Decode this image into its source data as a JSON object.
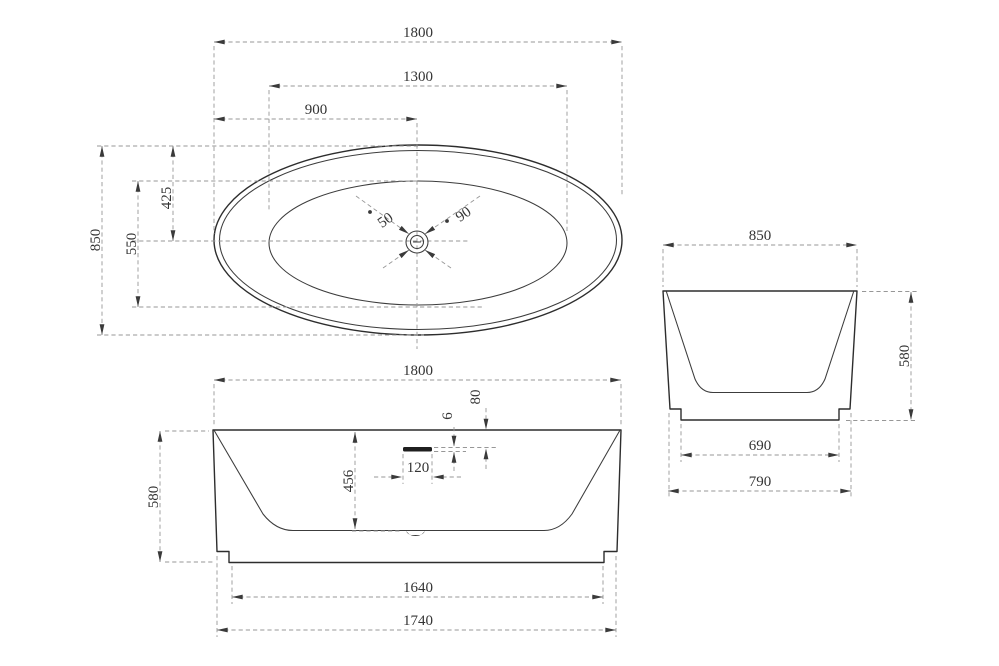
{
  "views": {
    "top": {
      "dims": {
        "overall_length": "1800",
        "basin_length": "1300",
        "drain_offset": "900",
        "overall_width": "850",
        "basin_width": "550",
        "half_width": "425",
        "drain_diameter": "50",
        "overflow_diameter": "90"
      }
    },
    "front": {
      "dims": {
        "overall_length": "1800",
        "overall_height": "580",
        "inner_depth": "456",
        "overflow_width": "120",
        "overflow_height": "6",
        "overflow_from_rim": "80",
        "base_length": "1640",
        "skirt_length": "1740"
      }
    },
    "end": {
      "dims": {
        "overall_width": "850",
        "overall_height": "580",
        "base_width": "690",
        "skirt_width": "790"
      }
    }
  },
  "colors": {
    "background": "#ffffff",
    "outline": "#2d2d2d",
    "dimension_lines": "#979797",
    "arrows_and_text": "#343434"
  }
}
